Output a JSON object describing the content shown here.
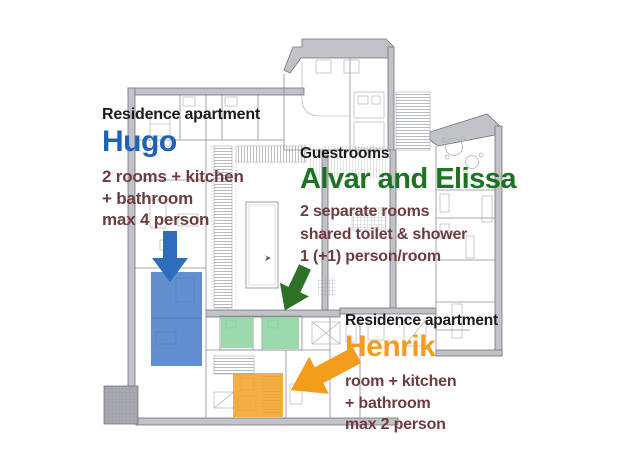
{
  "title": "Guesthouse floor plan with apartment annotations",
  "colors": {
    "label_black": "#1b1b1b",
    "detail_maroon": "#6e3c40",
    "hugo_blue": "#1e63b8",
    "alvar_green": "#1e7224",
    "henrik_orange": "#f79b1d",
    "arrow_blue": "#2e6cbd",
    "arrow_green": "#2d7226",
    "arrow_orange": "#f49d1c",
    "room_blue": "#3a72c0",
    "room_green": "#8bd49c",
    "room_orange": "#f3a024"
  },
  "apartments": {
    "hugo": {
      "category": "Residence apartment",
      "name": "Hugo",
      "details": [
        "2 rooms + kitchen",
        "+ bathroom",
        "max 4 person"
      ]
    },
    "alvar_elissa": {
      "category": "Guestrooms",
      "name": "Alvar and Elissa",
      "details": [
        "2 separate rooms",
        "shared toilet & shower",
        "1 (+1) person/room"
      ]
    },
    "henrik": {
      "category": "Residence apartment",
      "name": "Henrik",
      "details": [
        "room + kitchen",
        "+ bathroom",
        "max 2 person"
      ]
    }
  }
}
